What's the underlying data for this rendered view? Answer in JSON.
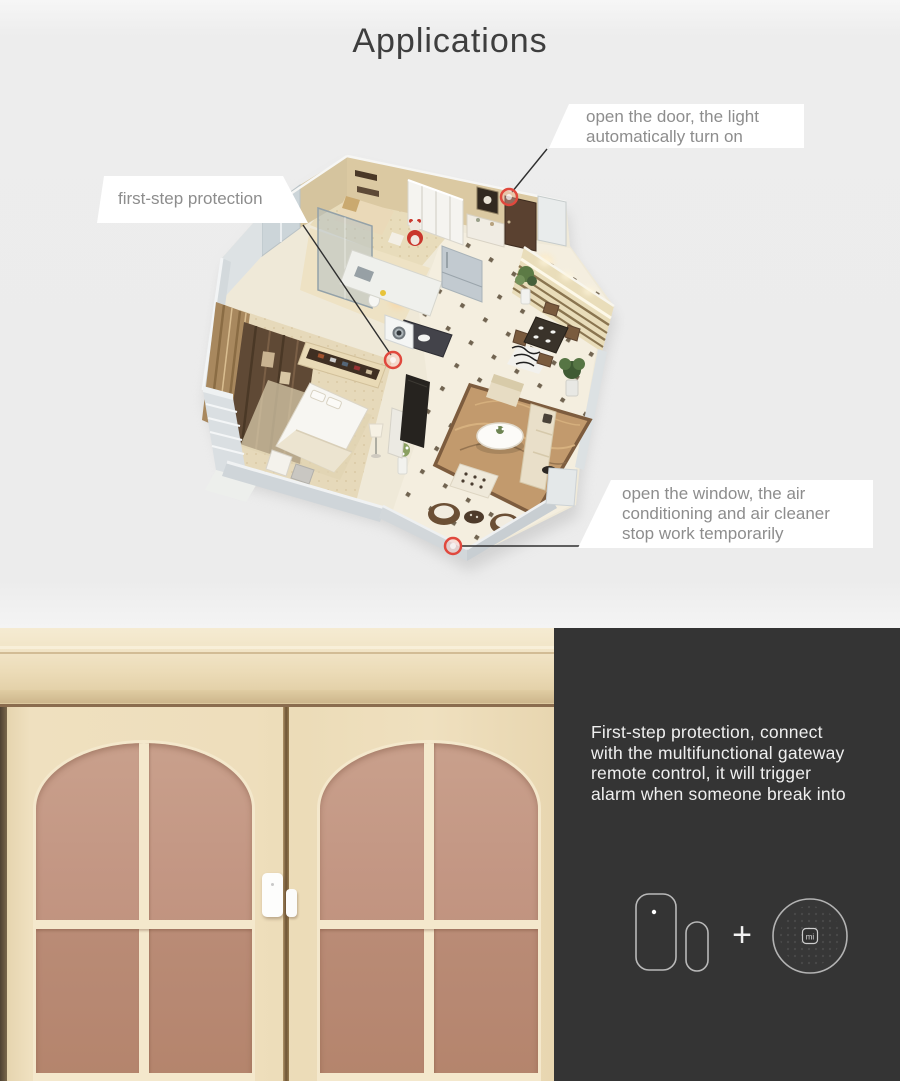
{
  "title": "Applications",
  "callouts": {
    "open_door": {
      "line1": "open the door, the light",
      "line2": "automatically turn on"
    },
    "first_step": {
      "label": "first-step protection"
    },
    "open_window": {
      "line1": "open the window, the air",
      "line2": "conditioning and air cleaner",
      "line3": "stop work temporarily"
    }
  },
  "info_panel": {
    "line1": "First-step protection, connect",
    "line2": "with the multifunctional gateway",
    "line3": "remote control, it will trigger",
    "line4": "alarm when someone break into",
    "plus": "+",
    "gateway_logo": "mi"
  },
  "colors": {
    "background": "#ededed",
    "callout_bg": "#ffffff",
    "callout_text": "#8d8d8d",
    "title_text": "#3e3e3e",
    "panel_bg": "#343434",
    "panel_text": "#efefef",
    "marker_red": "#e0483d",
    "door_cream": "#eadbb9",
    "glass_mauve": "#c49b86"
  }
}
